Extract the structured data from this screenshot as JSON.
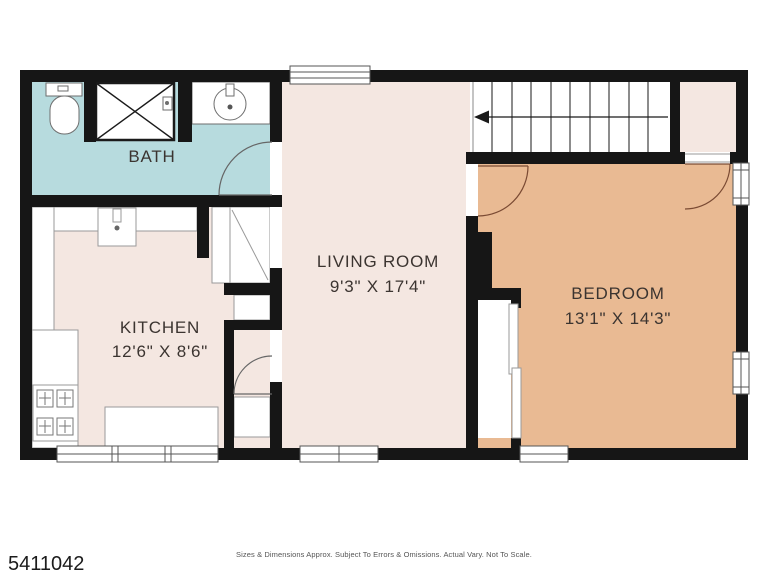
{
  "plan": {
    "rooms": {
      "bath": {
        "label": "BATH"
      },
      "kitchen": {
        "label": "KITCHEN",
        "dims": "12'6\" X 8'6\""
      },
      "living": {
        "label": "LIVING ROOM",
        "dims": "9'3\" X 17'4\""
      },
      "bedroom": {
        "label": "BEDROOM",
        "dims": "13'1\" X 14'3\""
      }
    },
    "colors": {
      "bath_floor": "#b7dbde",
      "light_floor": "#f4e7e1",
      "bedroom_floor": "#e9ba93",
      "wall": "#161616"
    }
  },
  "footer": {
    "listing_id": "5411042",
    "disclaimer": "Sizes & Dimensions Approx. Subject To Errors & Omissions. Actual Vary. Not To Scale."
  }
}
